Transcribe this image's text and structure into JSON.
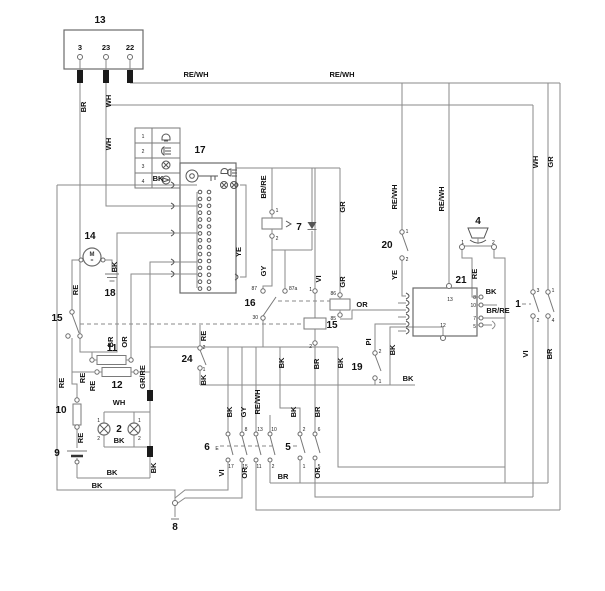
{
  "title": "vehicle wiring diagram",
  "colors": {
    "wire": "#8a8a8a",
    "outline": "#6b6b6b",
    "text": "#111111",
    "background": "#ffffff"
  },
  "components": [
    {
      "id": "13",
      "type": "control-box",
      "terminals": [
        "3",
        "23",
        "22"
      ]
    },
    {
      "id": "17",
      "type": "ignition-switch-connector-block",
      "icons": [
        "key",
        "bell",
        "headlight",
        "bulb",
        "bulb"
      ]
    },
    {
      "id": "legend",
      "type": "symbol-legend",
      "rows": [
        {
          "num": "1",
          "icon": "bell"
        },
        {
          "num": "2",
          "icon": "headlight"
        },
        {
          "num": "3",
          "icon": "bulb"
        },
        {
          "num": "4",
          "icon": "horn"
        }
      ]
    },
    {
      "id": "14",
      "type": "motor",
      "symbol": "M"
    },
    {
      "id": "18",
      "type": "ground"
    },
    {
      "id": "15",
      "type": "switch-with-relay-coil",
      "coil_terminals": [
        "1",
        "2"
      ]
    },
    {
      "id": "16",
      "type": "relay",
      "terminals": [
        "87",
        "87a",
        "30",
        "86",
        "85"
      ]
    },
    {
      "id": "11",
      "type": "fuse"
    },
    {
      "id": "12",
      "type": "fuse"
    },
    {
      "id": "10",
      "type": "fuse"
    },
    {
      "id": "9",
      "type": "battery"
    },
    {
      "id": "2",
      "type": "lamp-pair",
      "terminals": [
        "1",
        "2",
        "1",
        "2"
      ]
    },
    {
      "id": "24",
      "type": "switch",
      "terminals": [
        "2",
        "1"
      ]
    },
    {
      "id": "7",
      "type": "fuse",
      "terminals": [
        "1",
        "2"
      ]
    },
    {
      "id": "20",
      "type": "switch",
      "terminals": [
        "1",
        "2"
      ]
    },
    {
      "id": "19",
      "type": "switch",
      "terminals": [
        "2",
        "1"
      ]
    },
    {
      "id": "4",
      "type": "horn",
      "terminals": [
        "1",
        "2"
      ]
    },
    {
      "id": "21",
      "type": "connector",
      "right_pins": [
        "8",
        "10",
        "7",
        "5"
      ],
      "inner_pins": [
        "13",
        "12"
      ]
    },
    {
      "id": "1",
      "type": "switch",
      "terminals": [
        "3",
        "1",
        "2",
        "4"
      ]
    },
    {
      "id": "6",
      "type": "multi-switch",
      "marker": "E",
      "top_pins": [
        "8",
        "13",
        "10"
      ],
      "bottom_pins": [
        "17",
        "15",
        "11",
        "2"
      ]
    },
    {
      "id": "5",
      "type": "switch",
      "top_pins": [
        "2",
        "6"
      ],
      "bottom_pins": [
        "1",
        "5"
      ]
    },
    {
      "id": "8",
      "type": "terminal"
    }
  ],
  "wire_colors_used": [
    "BR",
    "WH",
    "RE/WH",
    "BK",
    "YE",
    "BR/RE",
    "GY",
    "VI",
    "GR",
    "RE",
    "OR",
    "GR/RE",
    "PI",
    "BR"
  ],
  "labels": [
    {
      "t": "13",
      "x": 100,
      "y": 23,
      "c": "k"
    },
    {
      "t": "3",
      "x": 80,
      "y": 50,
      "c": "w"
    },
    {
      "t": "23",
      "x": 106,
      "y": 50,
      "c": "w"
    },
    {
      "t": "22",
      "x": 130,
      "y": 50,
      "c": "w"
    },
    {
      "t": "RE/WH",
      "x": 196,
      "y": 77,
      "c": "w"
    },
    {
      "t": "RE/WH",
      "x": 342,
      "y": 77,
      "c": "w"
    },
    {
      "t": "BR",
      "x": 86,
      "y": 107,
      "c": "w",
      "r": 1
    },
    {
      "t": "WH",
      "x": 111,
      "y": 101,
      "c": "w",
      "r": 1
    },
    {
      "t": "WH",
      "x": 111,
      "y": 144,
      "c": "w",
      "r": 1
    },
    {
      "t": "1",
      "x": 143,
      "y": 138,
      "c": "t"
    },
    {
      "t": "2",
      "x": 143,
      "y": 153,
      "c": "t"
    },
    {
      "t": "3",
      "x": 143,
      "y": 168,
      "c": "t"
    },
    {
      "t": "4",
      "x": 143,
      "y": 183,
      "c": "t"
    },
    {
      "t": "17",
      "x": 200,
      "y": 153,
      "c": "k"
    },
    {
      "t": "BK",
      "x": 158,
      "y": 181,
      "c": "w"
    },
    {
      "t": "YE",
      "x": 241,
      "y": 252,
      "c": "w",
      "r": 1
    },
    {
      "t": "BR/RE",
      "x": 266,
      "y": 187,
      "c": "w",
      "r": 1
    },
    {
      "t": "7",
      "x": 299,
      "y": 230,
      "c": "k"
    },
    {
      "t": "1",
      "x": 277,
      "y": 212,
      "c": "t"
    },
    {
      "t": "2",
      "x": 277,
      "y": 240,
      "c": "t"
    },
    {
      "t": "GY",
      "x": 266,
      "y": 271,
      "c": "w",
      "r": 1
    },
    {
      "t": "VI",
      "x": 321,
      "y": 279,
      "c": "w",
      "r": 1
    },
    {
      "t": "GR",
      "x": 345,
      "y": 207,
      "c": "w",
      "r": 1
    },
    {
      "t": "GR",
      "x": 345,
      "y": 282,
      "c": "w",
      "r": 1
    },
    {
      "t": "RE/WH",
      "x": 397,
      "y": 197,
      "c": "w",
      "r": 1
    },
    {
      "t": "20",
      "x": 387,
      "y": 248,
      "c": "k"
    },
    {
      "t": "1",
      "x": 407,
      "y": 233,
      "c": "t"
    },
    {
      "t": "2",
      "x": 407,
      "y": 261,
      "c": "t"
    },
    {
      "t": "YE",
      "x": 397,
      "y": 275,
      "c": "w",
      "r": 1
    },
    {
      "t": "RE/WH",
      "x": 444,
      "y": 199,
      "c": "w",
      "r": 1
    },
    {
      "t": "WH",
      "x": 538,
      "y": 162,
      "c": "w",
      "r": 1
    },
    {
      "t": "GR",
      "x": 553,
      "y": 162,
      "c": "w",
      "r": 1
    },
    {
      "t": "4",
      "x": 478,
      "y": 224,
      "c": "k"
    },
    {
      "t": "1",
      "x": 464,
      "y": 244,
      "c": "t",
      "a": "e"
    },
    {
      "t": "2",
      "x": 492,
      "y": 244,
      "c": "t",
      "a": "s"
    },
    {
      "t": "RE",
      "x": 477,
      "y": 274,
      "c": "w",
      "r": 1
    },
    {
      "t": "21",
      "x": 461,
      "y": 283,
      "c": "k"
    },
    {
      "t": "13",
      "x": 450,
      "y": 301,
      "c": "t"
    },
    {
      "t": "12",
      "x": 443,
      "y": 327,
      "c": "t"
    },
    {
      "t": "8",
      "x": 476,
      "y": 299,
      "c": "t",
      "a": "e"
    },
    {
      "t": "10",
      "x": 476,
      "y": 307,
      "c": "t",
      "a": "e"
    },
    {
      "t": "7",
      "x": 476,
      "y": 320,
      "c": "t",
      "a": "e"
    },
    {
      "t": "5",
      "x": 476,
      "y": 328,
      "c": "t",
      "a": "e"
    },
    {
      "t": "BK",
      "x": 491,
      "y": 294,
      "c": "w"
    },
    {
      "t": "BR/RE",
      "x": 498,
      "y": 313,
      "c": "w"
    },
    {
      "t": "1",
      "x": 518,
      "y": 307,
      "c": "k"
    },
    {
      "t": "3",
      "x": 538,
      "y": 292,
      "c": "t"
    },
    {
      "t": "1",
      "x": 553,
      "y": 292,
      "c": "t"
    },
    {
      "t": "2",
      "x": 538,
      "y": 322,
      "c": "t"
    },
    {
      "t": "4",
      "x": 553,
      "y": 322,
      "c": "t"
    },
    {
      "t": "VI",
      "x": 528,
      "y": 354,
      "c": "w",
      "r": 1
    },
    {
      "t": "BR",
      "x": 552,
      "y": 354,
      "c": "w",
      "r": 1
    },
    {
      "t": "14",
      "x": 90,
      "y": 239,
      "c": "k"
    },
    {
      "t": "BK",
      "x": 117,
      "y": 267,
      "c": "w",
      "r": 1
    },
    {
      "t": "18",
      "x": 110,
      "y": 296,
      "c": "k"
    },
    {
      "t": "RE",
      "x": 78,
      "y": 290,
      "c": "w",
      "r": 1
    },
    {
      "t": "15",
      "x": 57,
      "y": 321,
      "c": "k"
    },
    {
      "t": "16",
      "x": 250,
      "y": 306,
      "c": "k"
    },
    {
      "t": "87",
      "x": 257,
      "y": 290,
      "c": "t",
      "a": "e"
    },
    {
      "t": "87a",
      "x": 289,
      "y": 290,
      "c": "t",
      "a": "s"
    },
    {
      "t": "30",
      "x": 258,
      "y": 319,
      "c": "t",
      "a": "e"
    },
    {
      "t": "86",
      "x": 336,
      "y": 295,
      "c": "t",
      "a": "e"
    },
    {
      "t": "85",
      "x": 336,
      "y": 320,
      "c": "t",
      "a": "e"
    },
    {
      "t": "1",
      "x": 312,
      "y": 291,
      "c": "t",
      "a": "e"
    },
    {
      "t": "2",
      "x": 312,
      "y": 348,
      "c": "t",
      "a": "e"
    },
    {
      "t": "15",
      "x": 332,
      "y": 328,
      "c": "k"
    },
    {
      "t": "OR",
      "x": 362,
      "y": 307,
      "c": "w"
    },
    {
      "t": "PI",
      "x": 371,
      "y": 342,
      "c": "w",
      "r": 1
    },
    {
      "t": "BK",
      "x": 395,
      "y": 350,
      "c": "w",
      "r": 1
    },
    {
      "t": "19",
      "x": 357,
      "y": 370,
      "c": "k"
    },
    {
      "t": "2",
      "x": 380,
      "y": 353,
      "c": "t"
    },
    {
      "t": "1",
      "x": 380,
      "y": 383,
      "c": "t"
    },
    {
      "t": "BK",
      "x": 408,
      "y": 381,
      "c": "w"
    },
    {
      "t": "BR",
      "x": 113,
      "y": 342,
      "c": "w",
      "r": 1
    },
    {
      "t": "OR",
      "x": 127,
      "y": 342,
      "c": "w",
      "r": 1
    },
    {
      "t": "11",
      "x": 112,
      "y": 351,
      "c": "k"
    },
    {
      "t": "12",
      "x": 117,
      "y": 388,
      "c": "k"
    },
    {
      "t": "RE",
      "x": 64,
      "y": 383,
      "c": "w",
      "r": 1
    },
    {
      "t": "RE",
      "x": 85,
      "y": 378,
      "c": "w",
      "r": 1
    },
    {
      "t": "RE",
      "x": 95,
      "y": 386,
      "c": "w",
      "r": 1
    },
    {
      "t": "GR/RE",
      "x": 145,
      "y": 377,
      "c": "w",
      "r": 1
    },
    {
      "t": "10",
      "x": 61,
      "y": 413,
      "c": "k"
    },
    {
      "t": "RE",
      "x": 83,
      "y": 438,
      "c": "w",
      "r": 1
    },
    {
      "t": "9",
      "x": 57,
      "y": 456,
      "c": "k"
    },
    {
      "t": "WH",
      "x": 119,
      "y": 405,
      "c": "w"
    },
    {
      "t": "2",
      "x": 119,
      "y": 432,
      "c": "k"
    },
    {
      "t": "BK",
      "x": 119,
      "y": 443,
      "c": "w"
    },
    {
      "t": "1",
      "x": 100,
      "y": 422,
      "c": "t",
      "a": "e"
    },
    {
      "t": "2",
      "x": 100,
      "y": 440,
      "c": "t",
      "a": "e"
    },
    {
      "t": "1",
      "x": 138,
      "y": 422,
      "c": "t",
      "a": "s"
    },
    {
      "t": "2",
      "x": 138,
      "y": 440,
      "c": "t",
      "a": "s"
    },
    {
      "t": "BK",
      "x": 156,
      "y": 468,
      "c": "w",
      "r": 1
    },
    {
      "t": "BK",
      "x": 112,
      "y": 475,
      "c": "w"
    },
    {
      "t": "BK",
      "x": 97,
      "y": 488,
      "c": "w"
    },
    {
      "t": "24",
      "x": 187,
      "y": 362,
      "c": "k"
    },
    {
      "t": "RE",
      "x": 206,
      "y": 336,
      "c": "w",
      "r": 1
    },
    {
      "t": "2",
      "x": 204,
      "y": 349,
      "c": "t"
    },
    {
      "t": "1",
      "x": 204,
      "y": 371,
      "c": "t"
    },
    {
      "t": "BK",
      "x": 206,
      "y": 380,
      "c": "w",
      "r": 1
    },
    {
      "t": "BK",
      "x": 232,
      "y": 412,
      "c": "w",
      "r": 1
    },
    {
      "t": "GY",
      "x": 246,
      "y": 412,
      "c": "w",
      "r": 1
    },
    {
      "t": "RE/WH",
      "x": 260,
      "y": 402,
      "c": "w",
      "r": 1
    },
    {
      "t": "BK",
      "x": 296,
      "y": 412,
      "c": "w",
      "r": 1
    },
    {
      "t": "BR",
      "x": 320,
      "y": 412,
      "c": "w",
      "r": 1
    },
    {
      "t": "BK",
      "x": 284,
      "y": 363,
      "c": "w",
      "r": 1
    },
    {
      "t": "BR",
      "x": 319,
      "y": 364,
      "c": "w",
      "r": 1
    },
    {
      "t": "BK",
      "x": 343,
      "y": 363,
      "c": "w",
      "r": 1
    },
    {
      "t": "6",
      "x": 207,
      "y": 450,
      "c": "k"
    },
    {
      "t": "E",
      "x": 217,
      "y": 450,
      "c": "t"
    },
    {
      "t": "8",
      "x": 246,
      "y": 431,
      "c": "t"
    },
    {
      "t": "13",
      "x": 260,
      "y": 431,
      "c": "t"
    },
    {
      "t": "10",
      "x": 274,
      "y": 431,
      "c": "t"
    },
    {
      "t": "17",
      "x": 231,
      "y": 468,
      "c": "t"
    },
    {
      "t": "15",
      "x": 245,
      "y": 468,
      "c": "t"
    },
    {
      "t": "11",
      "x": 259,
      "y": 468,
      "c": "t"
    },
    {
      "t": "2",
      "x": 273,
      "y": 468,
      "c": "t"
    },
    {
      "t": "5",
      "x": 288,
      "y": 450,
      "c": "k"
    },
    {
      "t": "2",
      "x": 304,
      "y": 431,
      "c": "t"
    },
    {
      "t": "6",
      "x": 319,
      "y": 431,
      "c": "t"
    },
    {
      "t": "1",
      "x": 304,
      "y": 468,
      "c": "t"
    },
    {
      "t": "5",
      "x": 319,
      "y": 468,
      "c": "t"
    },
    {
      "t": "VI",
      "x": 224,
      "y": 473,
      "c": "w",
      "r": 1
    },
    {
      "t": "OR",
      "x": 247,
      "y": 473,
      "c": "w",
      "r": 1
    },
    {
      "t": "BR",
      "x": 283,
      "y": 479,
      "c": "w"
    },
    {
      "t": "OR",
      "x": 320,
      "y": 473,
      "c": "w",
      "r": 1
    },
    {
      "t": "8",
      "x": 175,
      "y": 530,
      "c": "k"
    }
  ]
}
